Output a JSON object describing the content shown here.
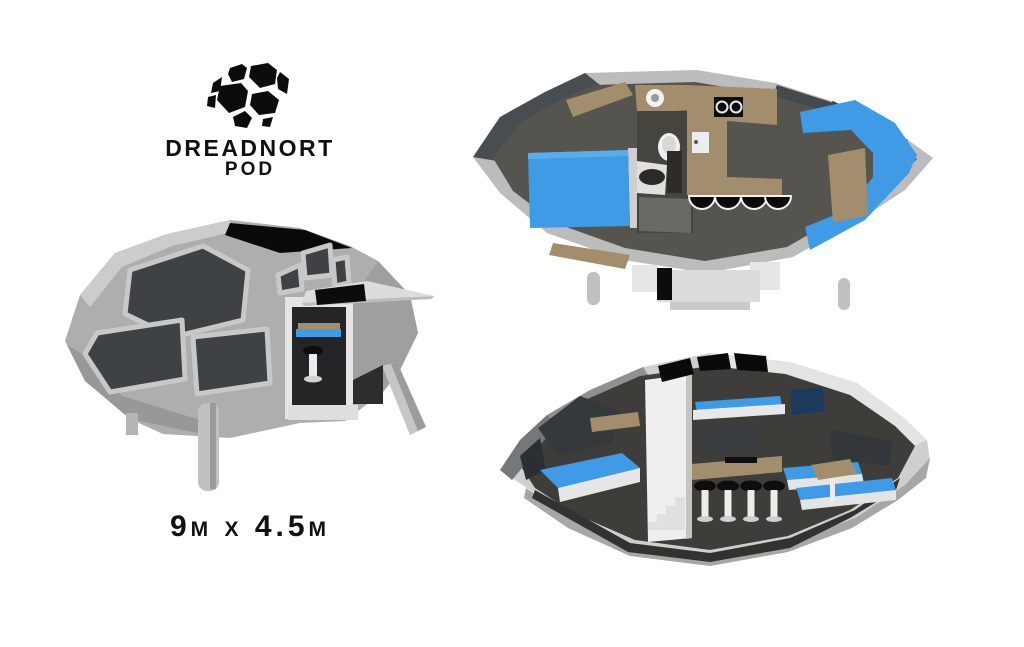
{
  "brand": {
    "logo_icon": "faceted-pod-ball",
    "name_line1": "DREADNORT",
    "name_line2": "POD"
  },
  "spec": {
    "dimensions_label": "9m x 4.5m"
  },
  "views": {
    "exterior": "pod-exterior-3d-view",
    "floor_plan": "pod-top-down-floor-plan-view",
    "cutaway": "pod-side-cutaway-view"
  },
  "colors": {
    "background": "#ffffff",
    "accent_blue": "#3f9be6",
    "navy_blue": "#1d3a5c",
    "tan": "#a28d6d",
    "shell_gray": "#bcbcbc",
    "window_charcoal": "#3e4244",
    "floor_gray": "#55534e",
    "black": "#0a0a0a"
  }
}
